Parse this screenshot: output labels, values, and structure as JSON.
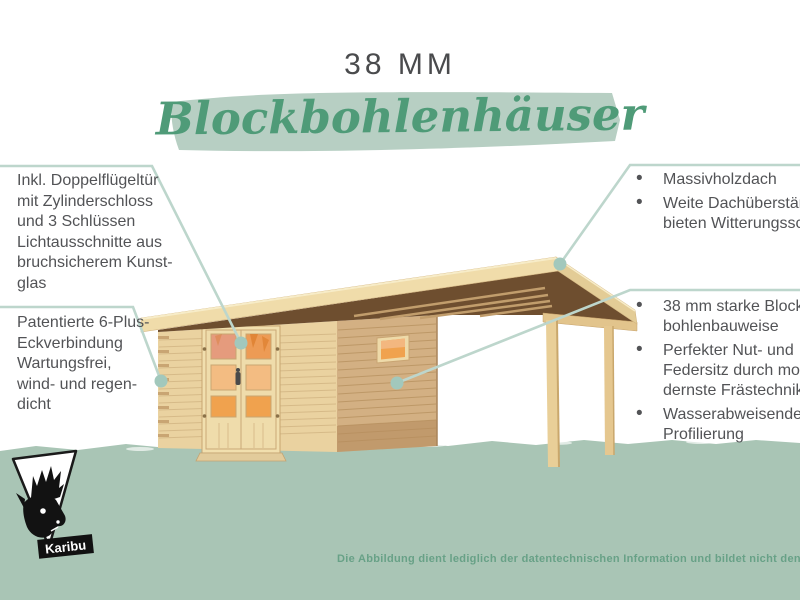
{
  "header": {
    "size_label": "38 MM",
    "title": "Blockbohlenhäuser"
  },
  "annotations": {
    "left": [
      {
        "target": "double-door",
        "lines": [
          "Inkl. Doppelflügeltür",
          "mit Zylinderschloss",
          "und 3 Schlüssen",
          "Lichtausschnitte aus",
          "bruchsicherem Kunst-",
          "glas"
        ]
      },
      {
        "target": "corner-joint",
        "lines": [
          "Patentierte 6-Plus-",
          "Eckverbindung",
          "Wartungsfrei,",
          "wind- und regen-",
          "dicht"
        ]
      }
    ],
    "right": [
      {
        "target": "roof",
        "items": [
          {
            "lines": [
              "Massivholzdach"
            ]
          },
          {
            "lines": [
              "Weite Dachüberstände",
              "bieten Witterungsschutz"
            ]
          }
        ]
      },
      {
        "target": "side-wall",
        "items": [
          {
            "lines": [
              "38 mm starke Block-",
              "bohlenbauweise"
            ]
          },
          {
            "lines": [
              "Perfekter Nut- und",
              "Federsitz durch mo",
              "dernste Frästechnik"
            ]
          },
          {
            "lines": [
              "Wasserabweisende",
              "Profilierung"
            ]
          }
        ]
      }
    ]
  },
  "footer": {
    "brand": "Karibu",
    "disclaimer": "Die Abbildung dient lediglich der datentechnischen Information und bildet nicht den tatsächlichen Artikel ab"
  },
  "colors": {
    "accent_green": "#4f9b78",
    "brush_green": "#b7cfc3",
    "band_green": "#a9c5b5",
    "callout_line": "#bdd6cc",
    "callout_dot": "#a2c8bc",
    "text_gray": "#525356",
    "footer_green": "#68a187",
    "wood_front": "#ead2a0",
    "wood_side": "#d3b083",
    "wood_roof": "#f0dcaa",
    "roof_underside": "#6e4e2f",
    "glass_orange": "#f0a24e"
  }
}
